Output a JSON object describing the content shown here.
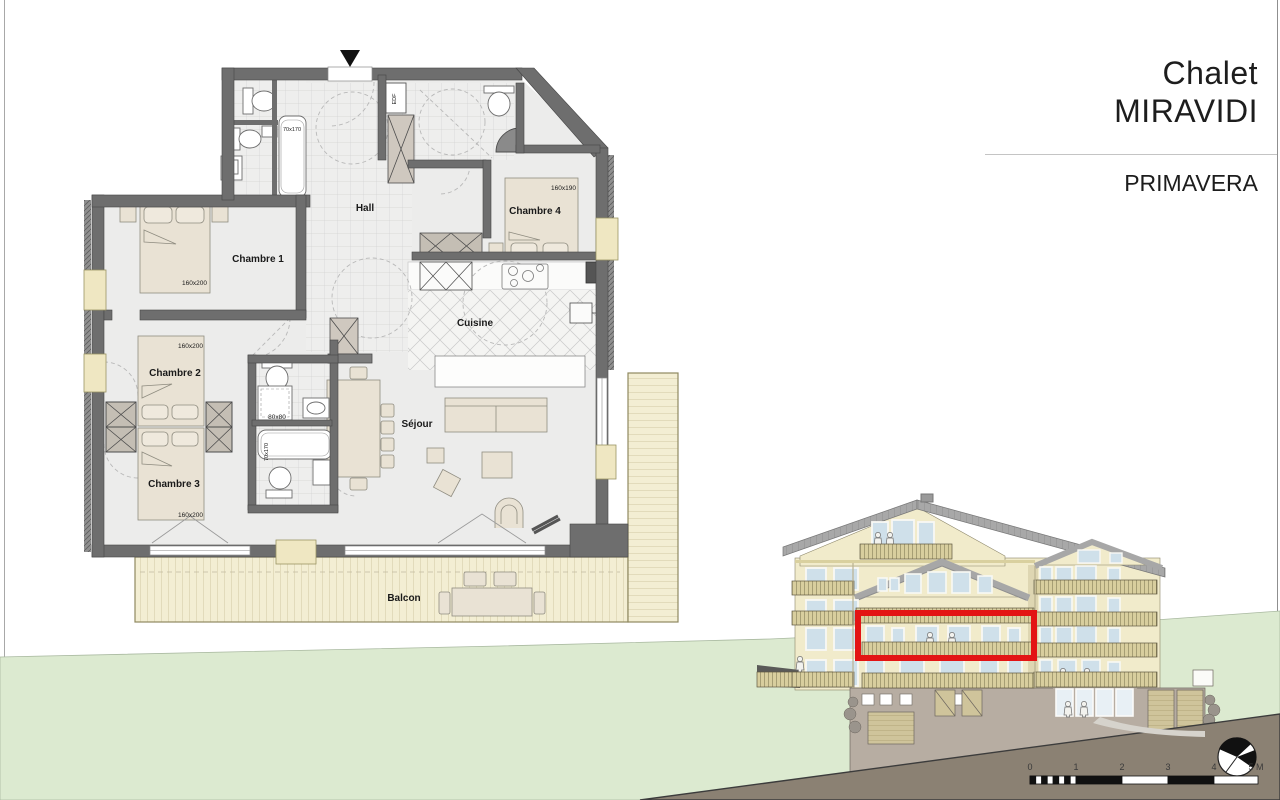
{
  "title_block": {
    "title_line1": "Chalet",
    "title_line2": "MIRAVIDI",
    "apartment_name": "PRIMAVERA"
  },
  "floor_plan": {
    "rooms": {
      "hall": "Hall",
      "chambre_1": "Chambre 1",
      "chambre_2": "Chambre 2",
      "chambre_3": "Chambre 3",
      "chambre_4": "Chambre 4",
      "cuisine": "Cuisine",
      "sejour": "Séjour",
      "balcon": "Balcon"
    },
    "dimensions": {
      "bed_chambre_1": "160x200",
      "bed_chambre_2": "160x200",
      "bed_chambre_3": "160x200",
      "bed_chambre_4": "160x190",
      "shower": "80x80",
      "bathtub_1": "70x170",
      "bathtub_2": "70x170"
    },
    "utility": {
      "edf_label": "EDF"
    }
  },
  "elevation": {
    "highlight_color": "#e31414",
    "scale_bar": {
      "labels": [
        "0",
        "1",
        "2",
        "3",
        "4",
        "5 M"
      ]
    }
  },
  "colors": {
    "wall": "#6e6e6e",
    "balcony_deck": "#f3eed3",
    "facade": "#f1ebcb",
    "roof": "#a7a7a7",
    "grass": "#dcead0",
    "slope": "#8b8173",
    "highlight": "#e31414"
  }
}
